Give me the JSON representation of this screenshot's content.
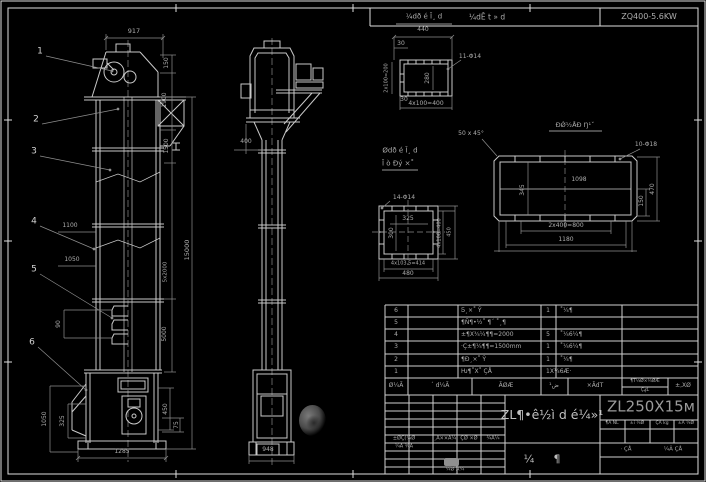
{
  "canvas": {
    "width": 706,
    "height": 482,
    "bg": "#000000",
    "line_color": "#cccccc",
    "dim_color": "#a6a6a6"
  },
  "header": {
    "left_label": "¼dÊ t » d",
    "right_label": "ZQ400-5.6KW"
  },
  "front_view": {
    "balloons": [
      "1",
      "2",
      "3",
      "4",
      "5",
      "6"
    ],
    "dim_top_width": "917",
    "dim_right_150": "150",
    "dim_right_1900": "1900",
    "dim_right_1500": "1500",
    "dim_right_sections": "5x2000",
    "dim_right_5000": "5000",
    "dim_right_total": "15000",
    "dim_left_1100": "1100",
    "dim_left_1050": "1050",
    "dim_left_bucket": "90",
    "dim_boot_left_1050": "1050",
    "dim_boot_left_325": "325",
    "dim_boot_right_450": "450",
    "dim_boot_right_75": "75",
    "dim_bottom_width": "1285"
  },
  "side_view": {
    "dim_head_400": "400",
    "dim_base_948": "948"
  },
  "detail_top_flange": {
    "label": "¼dð é Ī¸ d",
    "dim_440": "440",
    "dim_30": "30",
    "dim_left": "2x100=200",
    "dim_inner_280": "280",
    "dim_30b": "30",
    "dim_bottom": "4x100=400",
    "holes": "11-Φ14"
  },
  "detail_side_plate": {
    "label": "ĐǾ½ÅÐ Ŋ¹ˇ",
    "chamfer": "50 x 45°",
    "holes": "10-Φ18",
    "dim_1098": "1098",
    "dim_345": "345",
    "dim_150": "150",
    "dim_470": "470",
    "dim_800": "2x400=800",
    "dim_1180": "1180"
  },
  "detail_boot_flange": {
    "label_1": "Ødð é Ī¸ d",
    "label_2": "Ī ò Ðý ×˚",
    "holes": "14-Φ14",
    "dim_325": "325",
    "dim_300": "300",
    "dim_right_400": "4x100=400",
    "dim_right_450": "450",
    "dim_bottom_414": "4x103.5=414",
    "dim_bottom_480": "480"
  },
  "bom": {
    "header": {
      "no": "Ø¼Ã",
      "code": "´ d¼Ã",
      "name": "ÃØÆ",
      "qty": "ض¹",
      "material": "×ÃdT",
      "weight_top": "¶T¼Ø×¼ØÆ",
      "weight_bottom": "ÇؼL",
      "remark": "±,XØ"
    },
    "rows": [
      {
        "no": "6",
        "code": "",
        "name": "Ƽ¸×˚ Ŷ",
        "qty": "1",
        "material": "˚¼¶",
        "remark": ""
      },
      {
        "no": "5",
        "code": "",
        "name": "¶Ñ¶•½˚ ¶´ ˚¸¶",
        "qty": "",
        "material": "",
        "remark": ""
      },
      {
        "no": "4",
        "code": "",
        "name": "±¶X¾¼¶¶=2000",
        "qty": "5",
        "material": "˚¼6¼¶",
        "remark": ""
      },
      {
        "no": "3",
        "code": "",
        "name": "·Ç±¶¼¶¶=1500mm",
        "qty": "1",
        "material": "˚¼6¼¶",
        "remark": ""
      },
      {
        "no": "2",
        "code": "",
        "name": "¶Ð¸×˚ Ŷ",
        "qty": "1",
        "material": "˚¼¶",
        "remark": ""
      },
      {
        "no": "1",
        "code": "",
        "name": "Ƕ¶˚X˚ ÇÅ",
        "qty": "1X¼6Æ·",
        "material": "",
        "remark": ""
      }
    ]
  },
  "title_block": {
    "main_title": "ZL¶•ê½ì d é¼»¹",
    "model": "ZL250X15м",
    "type_char_a": "¼",
    "type_char_b": "¶",
    "rev_label_1": "±ØÇ(¼Ø",
    "rev_label_2": "¸Ã××Ã¼",
    "rev_label_3": "ÇØ ×Ø",
    "rev_label_4": "¾Ã¼",
    "design_label": "¼Ã ¾Ã",
    "check_label": "¼Ø Ã¼",
    "stage_label_1": "¶Ã ÑL",
    "stage_label_2": "±i ¼Ø",
    "stage_label_3": "ÇÃ kg",
    "stage_label_4": "±Ã ¼Ø",
    "sheet_total": "· ÇÅ",
    "sheet_no": "¼Ã ÇÅ"
  }
}
